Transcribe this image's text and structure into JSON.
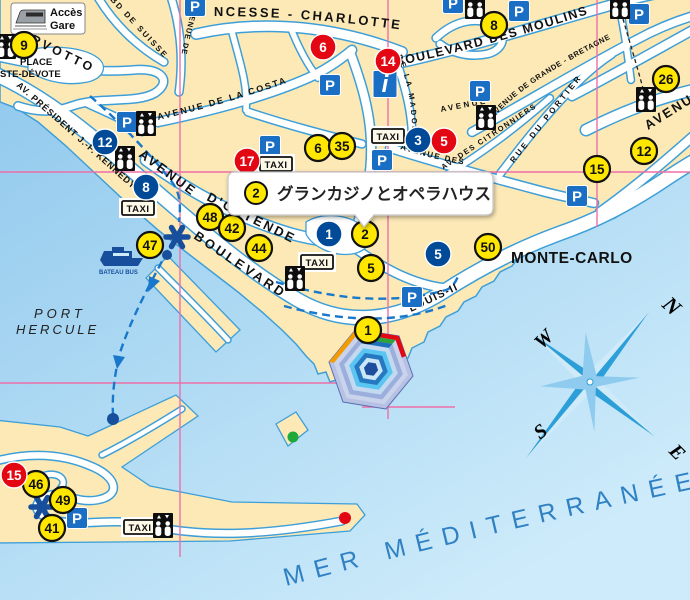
{
  "window": {
    "width": 690,
    "height": 600
  },
  "colors": {
    "sea_top": "#8CC6EC",
    "sea_bottom": "#CDEBFA",
    "land": "#FCE9B6",
    "road_casing": "#3E9FD8",
    "road_fill": "#FFFFFF",
    "grid": "#ED6FA8",
    "marker_yellow": "#FFE700",
    "marker_red": "#E30613",
    "marker_blue": "#004A98",
    "icon_blue": "#1A6FC4",
    "route_dash": "#1878CC",
    "dark_blue": "#174F9C",
    "sea_text": "#3081C4"
  },
  "legend_box": {
    "line1": "Accès",
    "line2": "Gare",
    "icon": "train-icon"
  },
  "tooltip": {
    "badge": "2",
    "text": "グランカジノとオペラハウス"
  },
  "labels": {
    "city": "MONTE-CARLO",
    "port_line1": "PORT",
    "port_line2": "HERCULE",
    "bateau_bus": "BATEAU BUS",
    "sea": "MER  MÉDITERRANÉE",
    "streets": {
      "charlotte": "NCESSE - CHARLOTTE",
      "moulins": "BOULEVARD DES MOULINS",
      "costa": "AVENUE DE LA COSTA",
      "kennedy": "AV. PRÉSIDENT J.-F. KENNEDY",
      "avenue_ostende": "AVENUE",
      "ostende": "D'OSTENDE",
      "boulevard": "BOULEVARD",
      "louis_ii": "LOUIS-II",
      "suisse": "BD DE SUISSE",
      "avenue_de": "AVENUE DE",
      "madone": "DE LA MADONE",
      "avenue_sm": "AVENUE",
      "grande_bretagne": "AVENUE DE GRANDE - BRETAGNE",
      "portier": "RUE DU PORTIER",
      "citronniers": "AV. DES CITRONNIERS",
      "avenue_des": "AVENUE DES",
      "avenue_right": "AVENUE",
      "de_right": "DE",
      "larvotto": "RVOTTO",
      "place_line1": "PLACE",
      "place_line2": "STE-DÉVOTE"
    }
  },
  "compass": {
    "n": "N",
    "e": "E",
    "s": "S",
    "w": "W"
  },
  "icons": {
    "parking_letter": "P",
    "taxi_label": "TAXI",
    "info_letter": "i"
  },
  "markers": {
    "yellow": [
      {
        "n": "9",
        "x": 24,
        "y": 45
      },
      {
        "n": "8",
        "x": 494,
        "y": 25
      },
      {
        "n": "26",
        "x": 666,
        "y": 79
      },
      {
        "n": "12",
        "x": 644,
        "y": 151
      },
      {
        "n": "15",
        "x": 597,
        "y": 169
      },
      {
        "n": "6",
        "x": 318,
        "y": 148
      },
      {
        "n": "35",
        "x": 342,
        "y": 146
      },
      {
        "n": "48",
        "x": 210,
        "y": 217
      },
      {
        "n": "42",
        "x": 232,
        "y": 228
      },
      {
        "n": "44",
        "x": 259,
        "y": 248
      },
      {
        "n": "2",
        "x": 365,
        "y": 234
      },
      {
        "n": "5",
        "x": 371,
        "y": 268
      },
      {
        "n": "50",
        "x": 488,
        "y": 247
      },
      {
        "n": "47",
        "x": 150,
        "y": 245
      },
      {
        "n": "1",
        "x": 368,
        "y": 330
      },
      {
        "n": "46",
        "x": 36,
        "y": 484
      },
      {
        "n": "49",
        "x": 63,
        "y": 500
      },
      {
        "n": "41",
        "x": 52,
        "y": 528
      }
    ],
    "red": [
      {
        "n": "6",
        "x": 323,
        "y": 47
      },
      {
        "n": "14",
        "x": 388,
        "y": 61
      },
      {
        "n": "17",
        "x": 247,
        "y": 161
      },
      {
        "n": "5",
        "x": 444,
        "y": 141
      },
      {
        "n": "15",
        "x": 14,
        "y": 475
      }
    ],
    "blue": [
      {
        "n": "12",
        "x": 105,
        "y": 142
      },
      {
        "n": "8",
        "x": 146,
        "y": 187
      },
      {
        "n": "3",
        "x": 418,
        "y": 140
      },
      {
        "n": "1",
        "x": 329,
        "y": 234
      },
      {
        "n": "5",
        "x": 438,
        "y": 254
      }
    ]
  },
  "poi": {
    "parking": [
      [
        195,
        6
      ],
      [
        453,
        3
      ],
      [
        519,
        11
      ],
      [
        639,
        14
      ],
      [
        127,
        122
      ],
      [
        330,
        85
      ],
      [
        480,
        91
      ],
      [
        270,
        146
      ],
      [
        382,
        160
      ],
      [
        577,
        196
      ],
      [
        412,
        297
      ],
      [
        77,
        518
      ]
    ],
    "taxi": [
      [
        388,
        136
      ],
      [
        276,
        164
      ],
      [
        138,
        208
      ],
      [
        317,
        262
      ],
      [
        140,
        527
      ]
    ],
    "elevator": [
      [
        146,
        123
      ],
      [
        125,
        158
      ],
      [
        6,
        46
      ],
      [
        295,
        278
      ],
      [
        486,
        117
      ],
      [
        620,
        6
      ],
      [
        475,
        6
      ],
      [
        646,
        99
      ],
      [
        163,
        525
      ]
    ],
    "info": [
      [
        385,
        84
      ]
    ],
    "stars": [
      [
        177,
        237
      ],
      [
        42,
        507
      ]
    ],
    "dots": [
      {
        "x": 167,
        "y": 255,
        "r": 5,
        "c": "#174F9C"
      },
      {
        "x": 113,
        "y": 419,
        "r": 6,
        "c": "#174F9C"
      },
      {
        "x": 345,
        "y": 518,
        "r": 6,
        "c": "#E30613"
      },
      {
        "x": 293,
        "y": 437,
        "r": 5.5,
        "c": "#1FA83C"
      }
    ]
  }
}
